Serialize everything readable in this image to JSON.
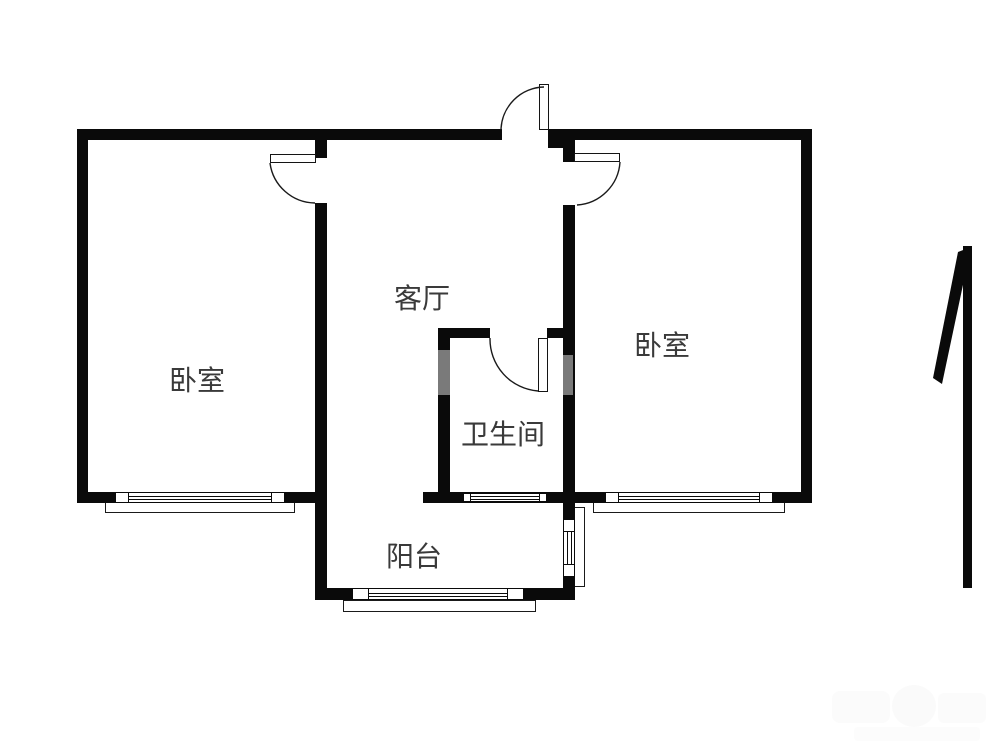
{
  "floorplan": {
    "rooms": [
      {
        "id": "bedroom-left",
        "label": "卧室"
      },
      {
        "id": "living-room",
        "label": "客厅"
      },
      {
        "id": "bedroom-right",
        "label": "卧室"
      },
      {
        "id": "bathroom",
        "label": "卫生间"
      },
      {
        "id": "balcony",
        "label": "阳台"
      }
    ],
    "colors": {
      "wall": "#0a0a0a",
      "label_text": "#3a3a3a",
      "background": "#ffffff"
    },
    "compass": {
      "icon": "north-arrow"
    }
  }
}
